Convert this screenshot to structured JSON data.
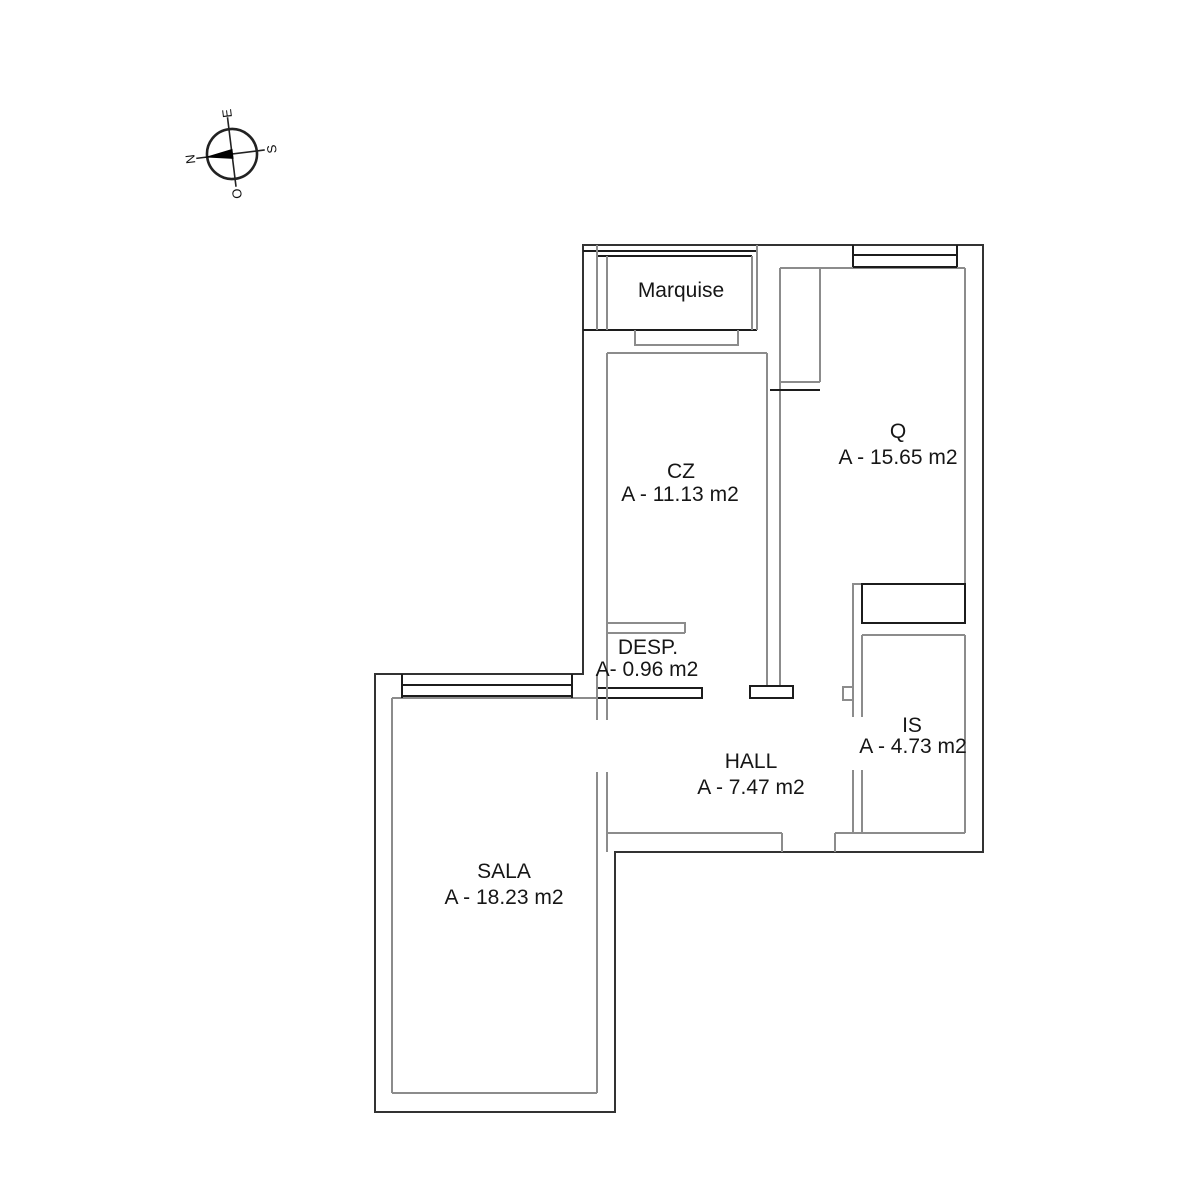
{
  "compass": {
    "letters": {
      "n": "N",
      "e": "E",
      "s": "S",
      "o": "O"
    }
  },
  "rooms": {
    "marquise": {
      "name": "Marquise"
    },
    "cz": {
      "name": "CZ",
      "area": "A - 11.13 m2"
    },
    "q": {
      "name": "Q",
      "area": "A - 15.65 m2"
    },
    "desp": {
      "name": "DESP.",
      "area": "A- 0.96 m2"
    },
    "is": {
      "name": "IS",
      "area": "A - 4.73 m2"
    },
    "hall": {
      "name": "HALL",
      "area": "A - 7.47 m2"
    },
    "sala": {
      "name": "SALA",
      "area": "A - 18.23 m2"
    }
  },
  "colors": {
    "wall_dark": "#333333",
    "wall_gray": "#8c8c8c",
    "needle": "#000000",
    "text": "#161616",
    "background": "#ffffff"
  }
}
